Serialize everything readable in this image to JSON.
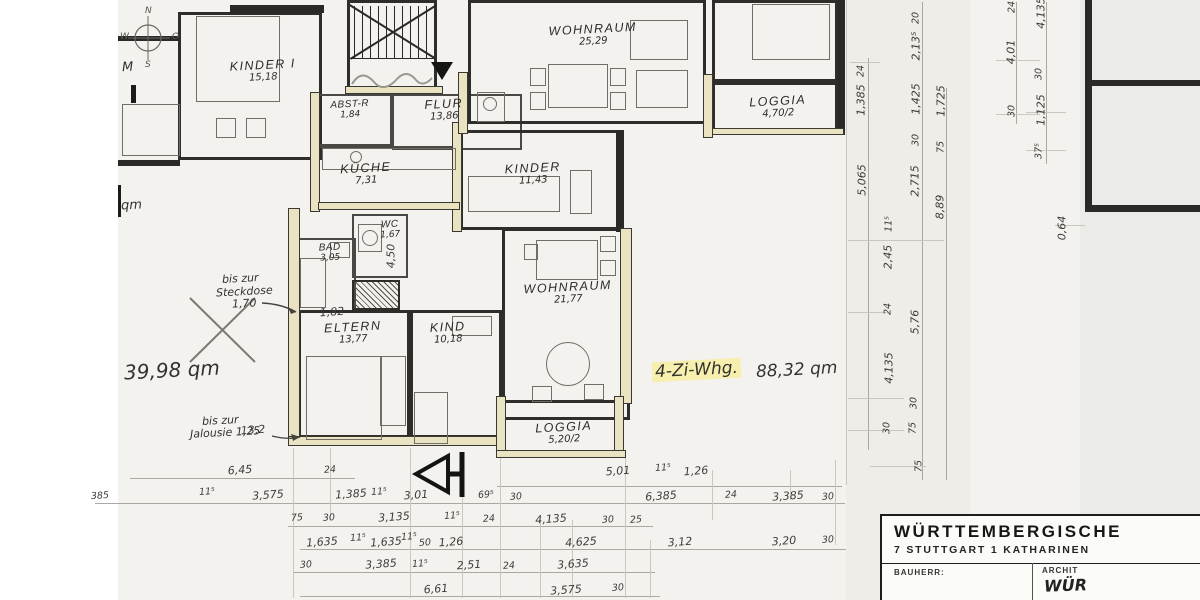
{
  "rooms": {
    "kinder1": {
      "label": "KINDER I",
      "area": "15,18"
    },
    "abstr": {
      "label": "ABST-R",
      "area": "1,84"
    },
    "flur": {
      "label": "FLUR",
      "area": "13,86"
    },
    "kueche": {
      "label": "KÜCHE",
      "area": "7,31"
    },
    "wohnraum_top": {
      "label": "WOHNRAUM",
      "area": "25,29"
    },
    "loggia_top": {
      "label": "LOGGIA",
      "area": "4,70/2"
    },
    "kinder2": {
      "label": "KINDER",
      "area": "11,43"
    },
    "wc": {
      "label": "WC",
      "area": "1,67"
    },
    "bad": {
      "label": "BAD",
      "area": "3,05"
    },
    "eltern": {
      "label": "ELTERN",
      "area": "13,77"
    },
    "kind": {
      "label": "KIND",
      "area": "10,18"
    },
    "wohnraum_mid": {
      "label": "WOHNRAUM",
      "area": "21,77"
    },
    "loggia_bottom": {
      "label": "LOGGIA",
      "area": "5,20/2"
    }
  },
  "annotations": {
    "area_left": "39,98 qm",
    "qm_cut": "qm",
    "m_cut": "M",
    "steckdose_l1": "bis zur",
    "steckdose_l2": "Steckdose",
    "steckdose_l3": "1,70",
    "jalousie_l1": "bis zur",
    "jalousie_l2": "Jalousie 1,25",
    "apt_type": "4-Zi-Whg.",
    "apt_area": "88,32 qm"
  },
  "compass": {
    "n": "N",
    "o": "O",
    "s": "S",
    "w": "W"
  },
  "titleblock": {
    "company": "WÜRTTEMBERGISCHE",
    "address": "7 STUTTGART 1   KATHARINEN",
    "bauherr_label": "BAUHERR:",
    "architekt_label": "ARCHIT",
    "architekt_value": "WÜR"
  },
  "dims_bottom": [
    {
      "t": "6,45",
      "x": 240,
      "y": 470
    },
    {
      "t": "24",
      "x": 330,
      "y": 470
    },
    {
      "t": "5,01",
      "x": 618,
      "y": 471
    },
    {
      "t": "11⁵",
      "x": 663,
      "y": 468
    },
    {
      "t": "1,26",
      "x": 696,
      "y": 471
    },
    {
      "t": "385",
      "x": 100,
      "y": 496
    },
    {
      "t": "11⁵",
      "x": 207,
      "y": 492
    },
    {
      "t": "3,575",
      "x": 268,
      "y": 495
    },
    {
      "t": "1,385",
      "x": 351,
      "y": 494
    },
    {
      "t": "11⁵",
      "x": 379,
      "y": 492
    },
    {
      "t": "3,01",
      "x": 416,
      "y": 495
    },
    {
      "t": "69⁵",
      "x": 486,
      "y": 495
    },
    {
      "t": "30",
      "x": 516,
      "y": 497
    },
    {
      "t": "6,385",
      "x": 661,
      "y": 496
    },
    {
      "t": "24",
      "x": 731,
      "y": 495
    },
    {
      "t": "3,385",
      "x": 788,
      "y": 496
    },
    {
      "t": "30",
      "x": 828,
      "y": 497
    },
    {
      "t": "75",
      "x": 297,
      "y": 518
    },
    {
      "t": "30",
      "x": 329,
      "y": 518
    },
    {
      "t": "3,135",
      "x": 394,
      "y": 517
    },
    {
      "t": "11⁵",
      "x": 452,
      "y": 516
    },
    {
      "t": "24",
      "x": 489,
      "y": 519
    },
    {
      "t": "4,135",
      "x": 551,
      "y": 519
    },
    {
      "t": "30",
      "x": 608,
      "y": 520
    },
    {
      "t": "25",
      "x": 636,
      "y": 520
    },
    {
      "t": "1,635",
      "x": 322,
      "y": 542
    },
    {
      "t": "11⁵",
      "x": 358,
      "y": 538
    },
    {
      "t": "1,635",
      "x": 386,
      "y": 542
    },
    {
      "t": "11⁵",
      "x": 409,
      "y": 537
    },
    {
      "t": "50",
      "x": 425,
      "y": 543
    },
    {
      "t": "1,26",
      "x": 451,
      "y": 542
    },
    {
      "t": "4,625",
      "x": 581,
      "y": 542
    },
    {
      "t": "3,12",
      "x": 680,
      "y": 542
    },
    {
      "t": "3,20",
      "x": 784,
      "y": 541
    },
    {
      "t": "30",
      "x": 828,
      "y": 540
    },
    {
      "t": "30",
      "x": 306,
      "y": 565
    },
    {
      "t": "3,385",
      "x": 381,
      "y": 564
    },
    {
      "t": "11⁵",
      "x": 420,
      "y": 564
    },
    {
      "t": "2,51",
      "x": 469,
      "y": 565
    },
    {
      "t": "24",
      "x": 509,
      "y": 566
    },
    {
      "t": "3,635",
      "x": 573,
      "y": 564
    },
    {
      "t": "6,61",
      "x": 436,
      "y": 589
    },
    {
      "t": "3,575",
      "x": 566,
      "y": 590
    },
    {
      "t": "30",
      "x": 618,
      "y": 588
    }
  ],
  "dims_right": [
    {
      "t": "24",
      "x": 861,
      "y": 71
    },
    {
      "t": "1,385",
      "x": 861,
      "y": 100
    },
    {
      "t": "5,065",
      "x": 862,
      "y": 180
    },
    {
      "t": "11⁵",
      "x": 889,
      "y": 224
    },
    {
      "t": "2,45",
      "x": 888,
      "y": 257
    },
    {
      "t": "24",
      "x": 888,
      "y": 309
    },
    {
      "t": "4,135",
      "x": 889,
      "y": 368
    },
    {
      "t": "30",
      "x": 887,
      "y": 428
    },
    {
      "t": "20",
      "x": 916,
      "y": 18
    },
    {
      "t": "2,13⁵",
      "x": 916,
      "y": 46
    },
    {
      "t": "1,425",
      "x": 916,
      "y": 99
    },
    {
      "t": "30",
      "x": 916,
      "y": 140
    },
    {
      "t": "2,715",
      "x": 915,
      "y": 181
    },
    {
      "t": "5,76",
      "x": 915,
      "y": 322
    },
    {
      "t": "30",
      "x": 914,
      "y": 403
    },
    {
      "t": "75",
      "x": 913,
      "y": 428
    },
    {
      "t": "75",
      "x": 919,
      "y": 466
    },
    {
      "t": "1,725",
      "x": 941,
      "y": 101
    },
    {
      "t": "75",
      "x": 941,
      "y": 147
    },
    {
      "t": "8,89",
      "x": 940,
      "y": 207
    },
    {
      "t": "24",
      "x": 1012,
      "y": 7
    },
    {
      "t": "4,01",
      "x": 1011,
      "y": 52
    },
    {
      "t": "30",
      "x": 1012,
      "y": 111
    },
    {
      "t": "4,135",
      "x": 1041,
      "y": 13
    },
    {
      "t": "30",
      "x": 1039,
      "y": 74
    },
    {
      "t": "1,125",
      "x": 1041,
      "y": 110
    },
    {
      "t": "37⁵",
      "x": 1039,
      "y": 151
    },
    {
      "t": "0,64",
      "x": 1062,
      "y": 228
    }
  ],
  "dims_plan": [
    {
      "t": "1,82",
      "x": 332,
      "y": 312,
      "r": 0
    },
    {
      "t": "4,50",
      "x": 391,
      "y": 256,
      "r": 1
    },
    {
      "t": "13,2",
      "x": 253,
      "y": 430,
      "r": 0
    }
  ]
}
